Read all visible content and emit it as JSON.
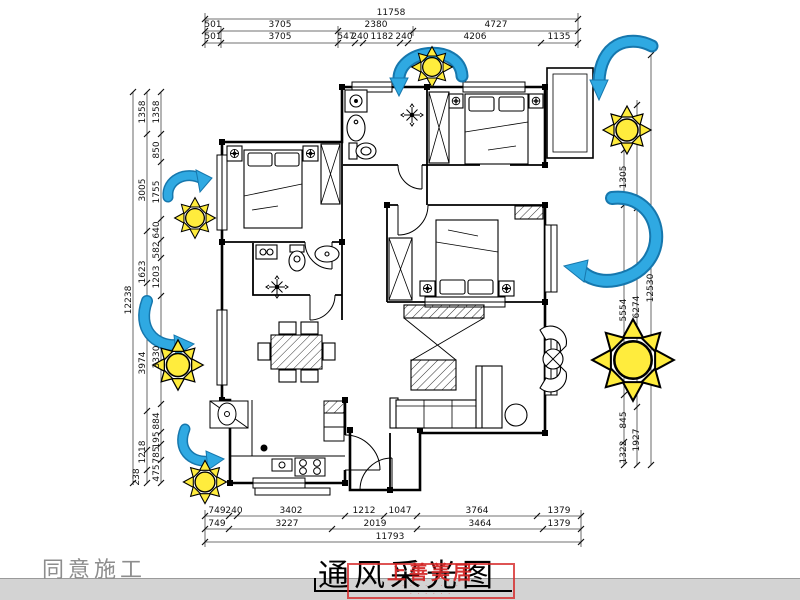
{
  "title": {
    "text": "通风采光图"
  },
  "corner_note": "同意施工",
  "watermark": {
    "text": "上善美居",
    "sub1": "· · · · · · · · · ·",
    "sub2": "· · · · · ·",
    "color": "#d23232"
  },
  "colors": {
    "wind_arrow": "#2fa9e2",
    "wind_arrow_dark": "#1677ad",
    "sun": "#ffec3d",
    "walls": "#000000"
  },
  "icons": {
    "wind": "wind-arrow",
    "sun": "sun-icon",
    "fan": "exhaust-fan-icon"
  },
  "dims": {
    "top": {
      "total": "11758",
      "row1": [
        "501",
        "3705",
        "2380",
        "4727"
      ],
      "row2": [
        "501",
        "3705",
        "547",
        "240",
        "1182",
        "240",
        "4206",
        "1135"
      ]
    },
    "bottom": {
      "row1": [
        "749",
        "240",
        "3402",
        "1212",
        "1047",
        "3764",
        "1379"
      ],
      "row2": [
        "749",
        "3227",
        "2019",
        "3464",
        "1379"
      ],
      "total": "11793"
    },
    "left": {
      "total": "12238",
      "mid": [
        "1358",
        "3005",
        "1623",
        "3974",
        "1218",
        "238"
      ],
      "inner": [
        "1358",
        "850",
        "1755",
        "640",
        "582",
        "1203",
        "3330",
        "884",
        "195",
        "785",
        "475"
      ]
    },
    "right": {
      "total": "12530",
      "mid": [
        "1305",
        "5554",
        "845",
        "1322"
      ],
      "inner": [
        "6274",
        "1927"
      ]
    }
  }
}
